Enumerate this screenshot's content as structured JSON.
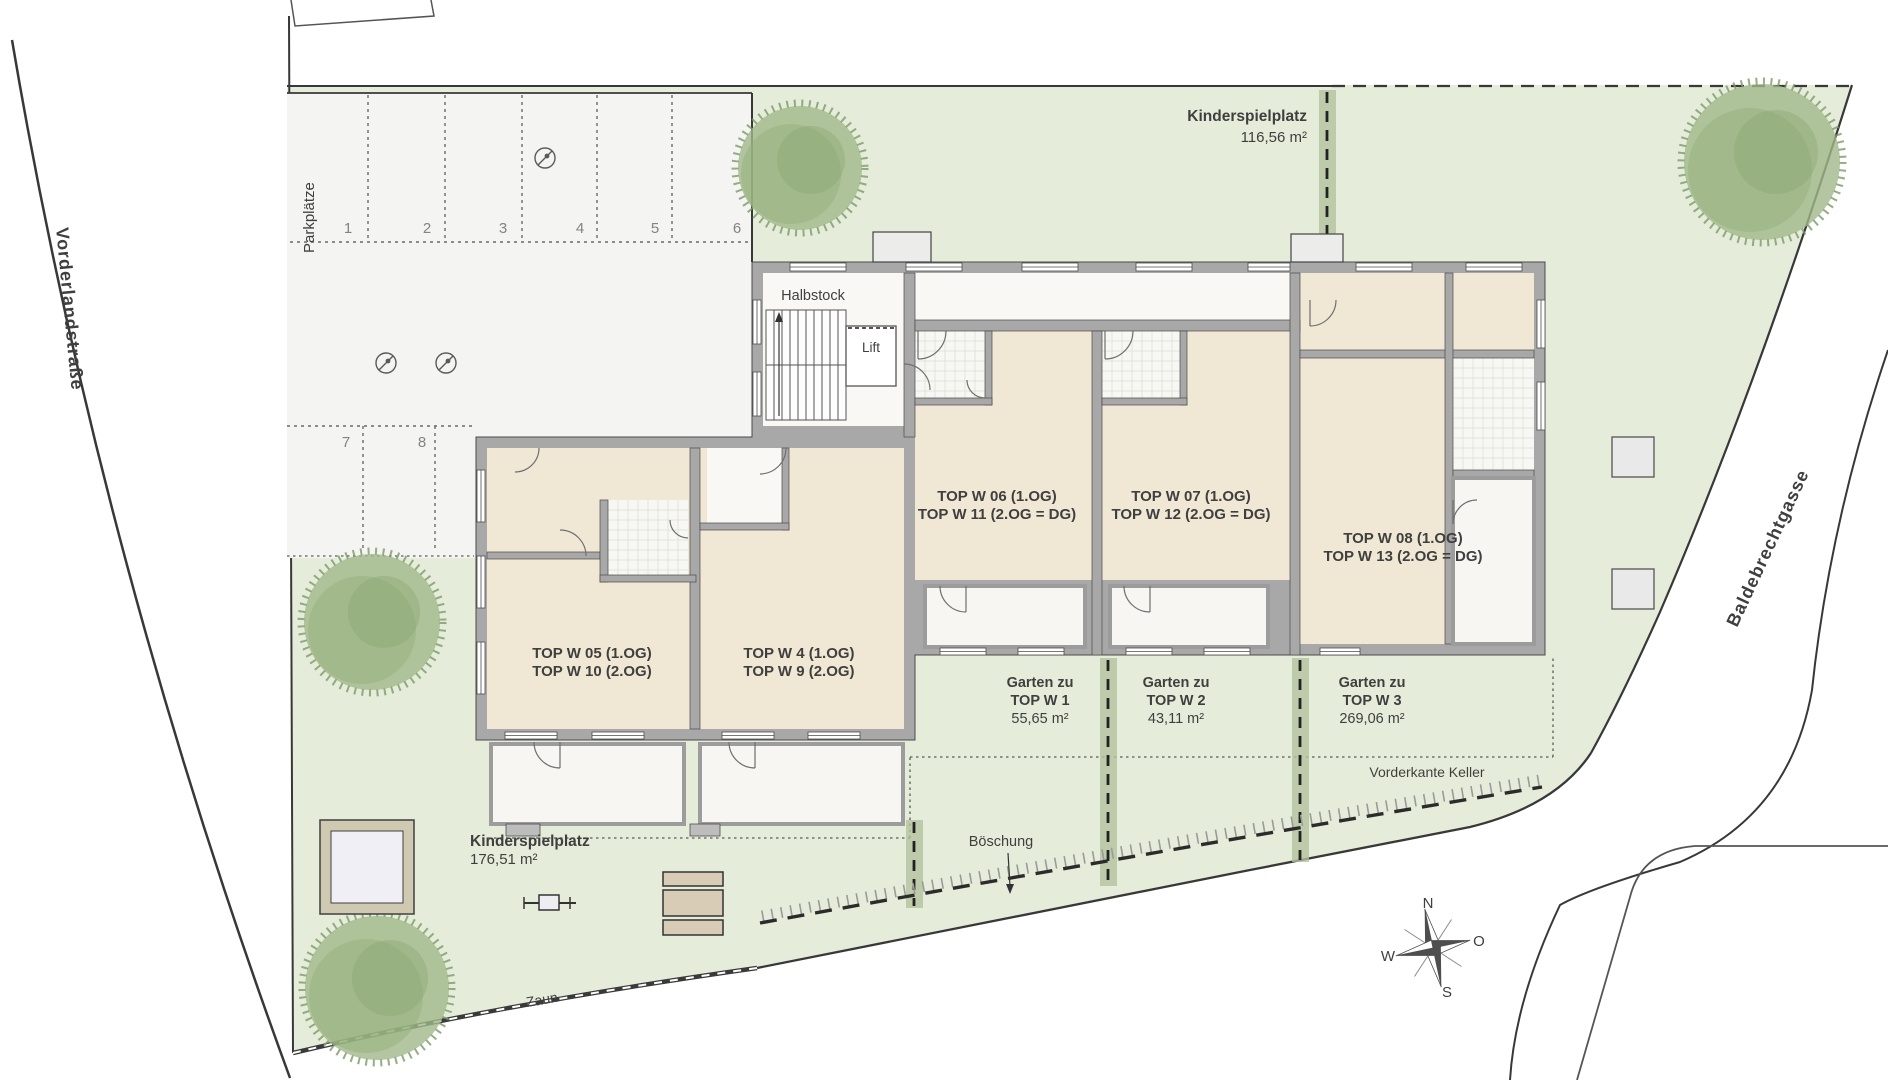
{
  "plan": {
    "streets": {
      "left": "Vorderlandstraße",
      "right": "Baldebrechtgasse"
    },
    "parking": {
      "label": "Parkplätze",
      "spots": [
        "1",
        "2",
        "3",
        "4",
        "5",
        "6",
        "7",
        "8"
      ]
    },
    "building": {
      "halbstock": "Halbstock",
      "lift": "Lift"
    },
    "apartments": [
      {
        "line1": "TOP W 05 (1.OG)",
        "line2": "TOP W 10 (2.OG)"
      },
      {
        "line1": "TOP W 4 (1.OG)",
        "line2": "TOP W 9 (2.OG)"
      },
      {
        "line1": "TOP W 06 (1.OG)",
        "line2": "TOP W 11 (2.OG = DG)"
      },
      {
        "line1": "TOP W 07 (1.OG)",
        "line2": "TOP W 12 (2.OG = DG)"
      },
      {
        "line1": "TOP W 08 (1.OG)",
        "line2": "TOP W 13 (2.OG = DG)"
      }
    ],
    "gardens": [
      {
        "line1": "Garten zu",
        "line2": "TOP W 1",
        "area": "55,65 m²"
      },
      {
        "line1": "Garten zu",
        "line2": "TOP W 2",
        "area": "43,11 m²"
      },
      {
        "line1": "Garten zu",
        "line2": "TOP W 3",
        "area": "269,06 m²"
      }
    ],
    "playgrounds": [
      {
        "name": "Kinderspielplatz",
        "area": "116,56 m²"
      },
      {
        "name": "Kinderspielplatz",
        "area": "176,51 m²"
      }
    ],
    "annotations": {
      "keller": "Vorderkante Keller",
      "boeschung": "Böschung",
      "zaun": "Zaun"
    },
    "compass": {
      "n": "N",
      "o": "O",
      "s": "S",
      "w": "W"
    },
    "colors": {
      "site_green": "#e5edda",
      "parking": "#f4f4f2",
      "wall": "#a8a8a8",
      "room": "#f0e8d5",
      "hedge": "#b3c29e",
      "bench": "#d9ccb6",
      "tree": "#a0b889"
    }
  }
}
